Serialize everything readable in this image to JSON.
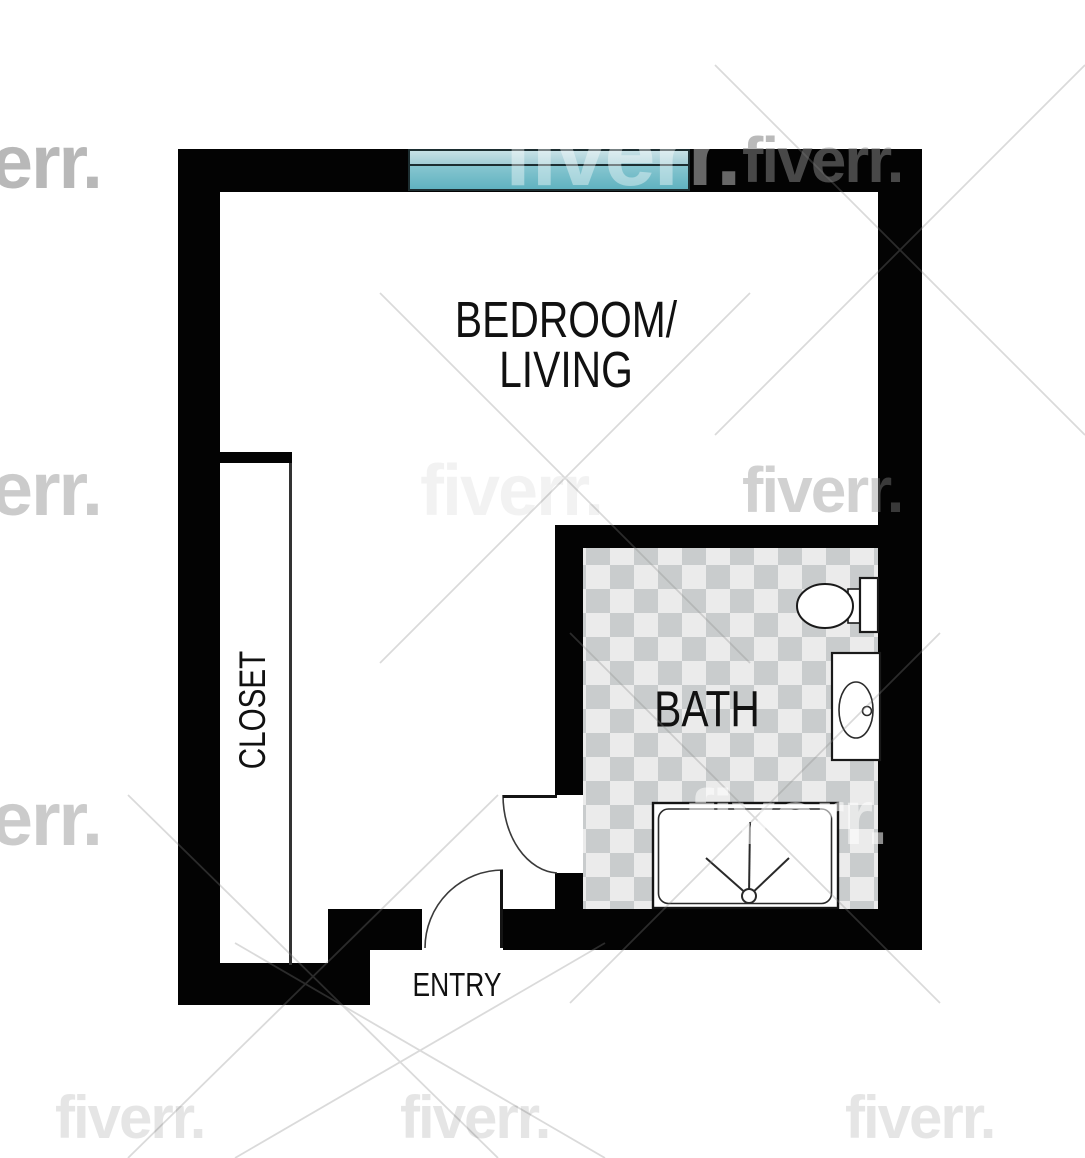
{
  "page": {
    "width": 1085,
    "height": 1158,
    "background": "#ffffff",
    "type": "apartment-floor-plan"
  },
  "watermark": {
    "text": "fiverr."
  },
  "rooms": {
    "bedroom_living": {
      "label_line1": "BEDROOM/",
      "label_line2": "LIVING"
    },
    "closet": {
      "label": "CLOSET"
    },
    "bath": {
      "label": "BATH"
    },
    "entry": {
      "label": "ENTRY"
    }
  },
  "fixtures": {
    "window": "picture-window",
    "toilet": "toilet",
    "sink": "sink-vanity-with-basin",
    "shower": "shower-pan-with-drain",
    "doors": [
      "entry-swing-door",
      "bath-swing-door"
    ]
  },
  "colors": {
    "wall": "#030303",
    "floor": "#ffffff",
    "label": "#111111",
    "line": "#333333",
    "tile_light": "#ebebeb",
    "tile_dark": "#c9cccd",
    "window_border": "#1d2e31",
    "window_light_top": "#c6e1e6",
    "window_light_bottom": "#a3ced6",
    "window_dark_top": "#87c6d0",
    "window_dark_bottom": "#60b2c0",
    "watermark_gray": "#8c8c8c"
  }
}
